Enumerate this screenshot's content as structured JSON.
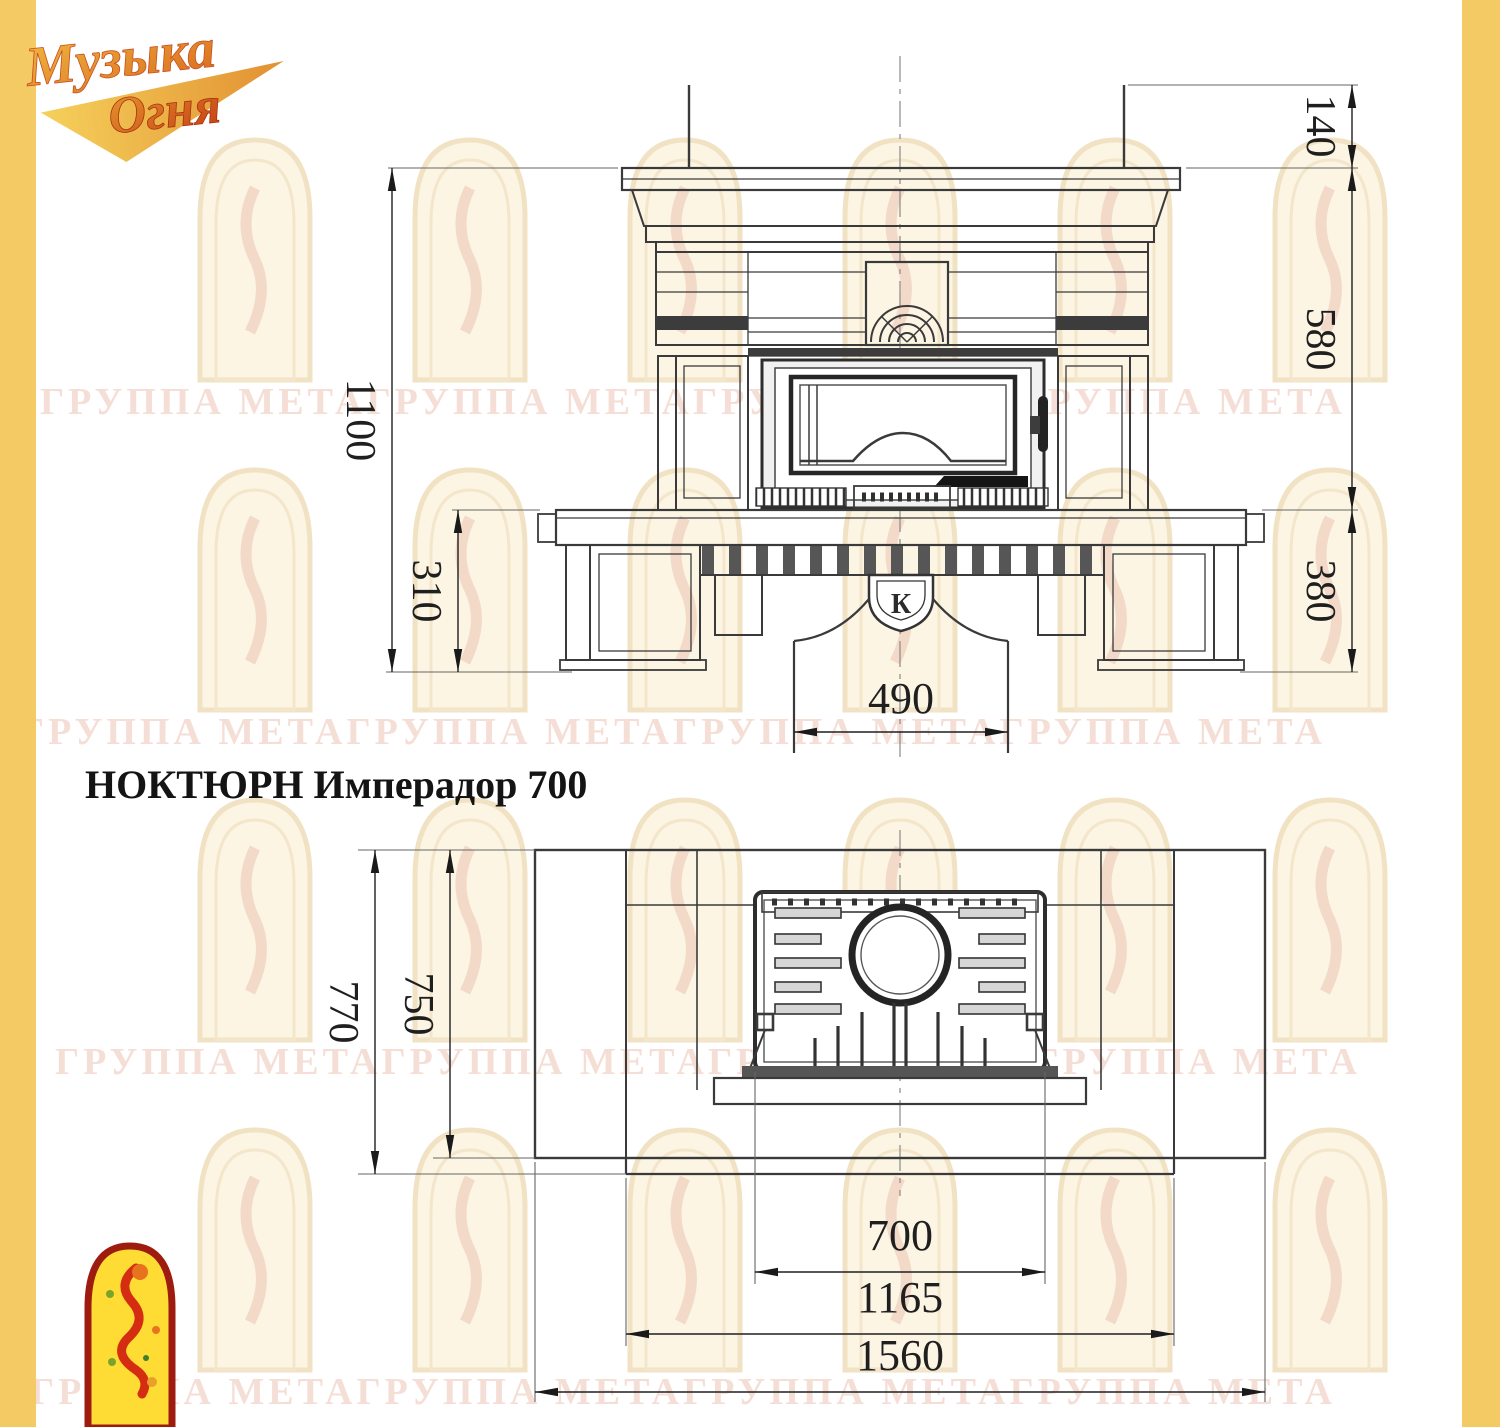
{
  "brand": {
    "logo_line1": "Музыка",
    "logo_line2": "Огня"
  },
  "title": "НОКТЮРН Имперадор 700",
  "watermark_text": "ГРУППА МЕТАГРУППА МЕТАГРУППА МЕТАГРУППА МЕТА",
  "front_view": {
    "dims": {
      "overall_height": "1100",
      "plinth_height": "310",
      "cornice_height": "140",
      "firebox_height": "580",
      "base_height": "380",
      "duct_width": "490"
    },
    "emblem_letter": "К"
  },
  "plan_view": {
    "dims": {
      "overall_depth": "770",
      "body_depth": "750",
      "insert_width": "700",
      "body_width": "1165",
      "overall_width": "1560"
    }
  },
  "colors": {
    "border_yellow": "#F3CA64",
    "line_dark": "#2d2d2d",
    "watermark_pink": "#F3D7CD",
    "logo_gold": "#E9A93E",
    "logo_red": "#C94E1E",
    "mascot_yellow": "#FFDC33",
    "mascot_red": "#D42D12"
  }
}
